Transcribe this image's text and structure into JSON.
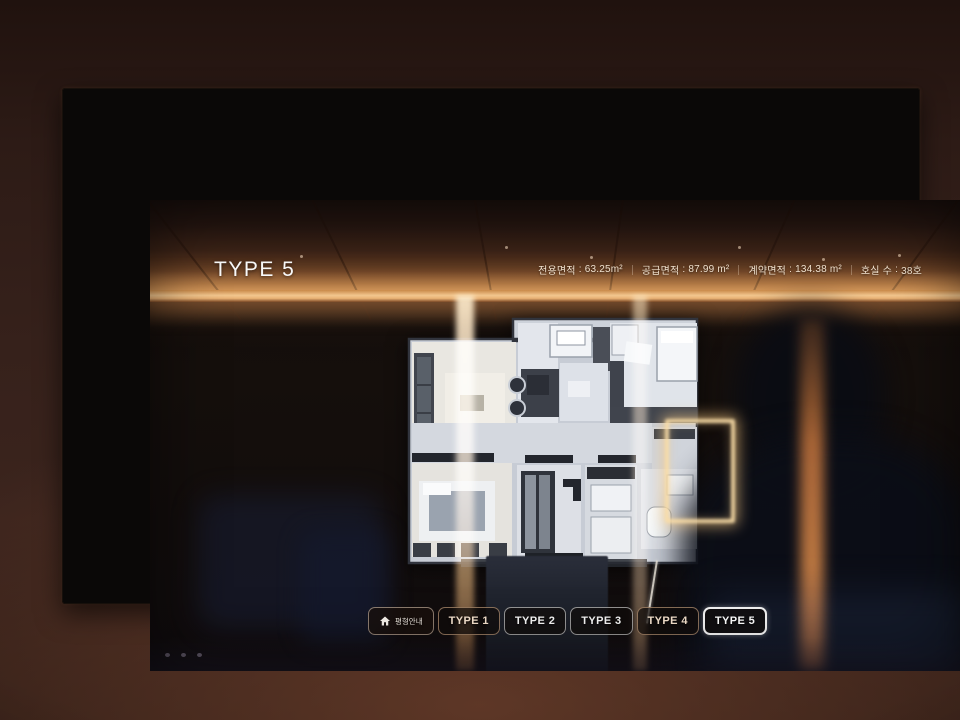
{
  "header": {
    "title": "TYPE 5",
    "separator": ":",
    "stats": [
      {
        "label": "전용면적",
        "value": "63.25m²"
      },
      {
        "label": "공급면적",
        "value": "87.99 m²"
      },
      {
        "label": "계약면적",
        "value": "134.38 m²"
      },
      {
        "label": "호실 수",
        "value": "38호"
      }
    ]
  },
  "nav": {
    "home": {
      "label": "평형안내",
      "icon": "home-icon"
    },
    "tabs": [
      {
        "label": "TYPE 1",
        "active": false
      },
      {
        "label": "TYPE 2",
        "active": false
      },
      {
        "label": "TYPE 3",
        "active": false
      },
      {
        "label": "TYPE 4",
        "active": false
      },
      {
        "label": "TYPE 5",
        "active": true
      }
    ]
  },
  "colors": {
    "accent_amber": "#e9b275",
    "glow_band": "#f2c68e",
    "screen_background": "#140e0c",
    "button_border": "#ffffff",
    "active_button_border": "#ffffff",
    "wall_brown": "#3b241d"
  }
}
